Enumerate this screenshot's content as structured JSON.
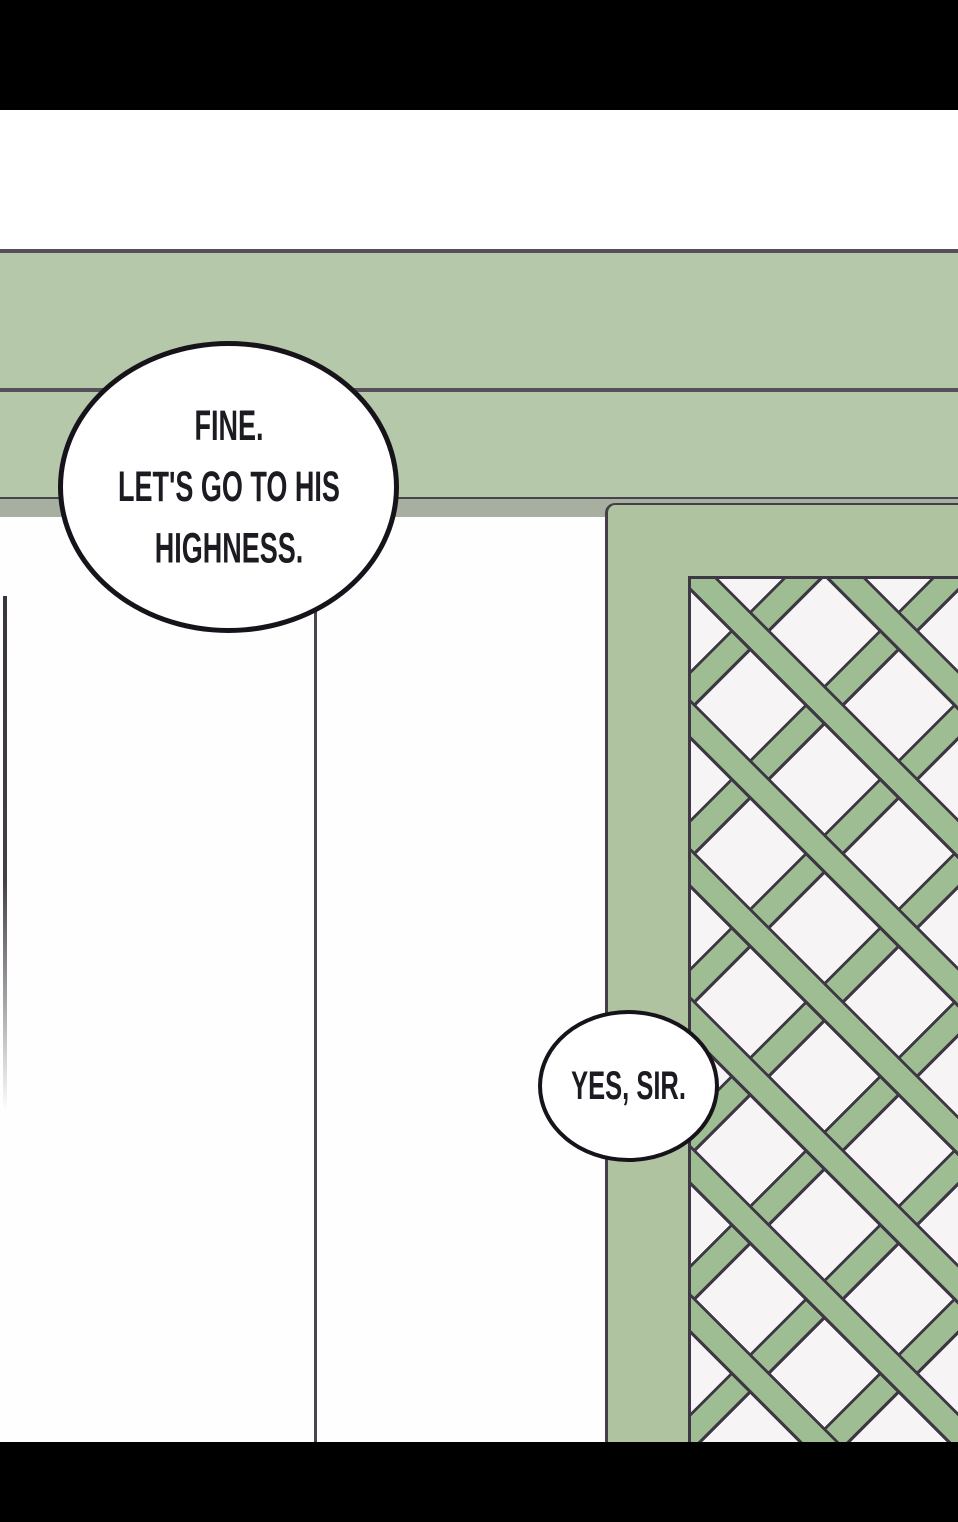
{
  "panel": {
    "kind": "webtoon-comic-panel",
    "bubbles": [
      {
        "id": "bubble-1",
        "lines": [
          "FINE.",
          "LET'S GO TO HIS",
          "HIGHNESS."
        ]
      },
      {
        "id": "bubble-2",
        "lines": [
          "YES, SIR."
        ]
      }
    ],
    "colors": {
      "letterbox_black": "#000000",
      "background_white": "#ffffff",
      "band_green": "#b6c8aa",
      "beam_shadow_gray": "#a7afa1",
      "pillar_green": "#afc3a1",
      "lattice_green": "#9ebd92",
      "diamond_white": "#f6f4f5",
      "outline_dark": "#3e3844",
      "rule_line_dark": "#56505a",
      "bubble_border_black": "#16131a",
      "speech_text_color": "#1e1a21"
    }
  }
}
